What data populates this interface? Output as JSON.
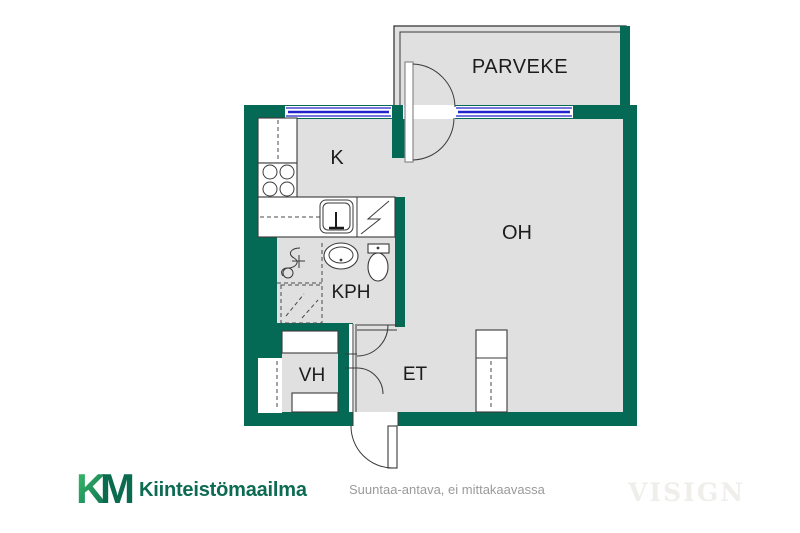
{
  "floorplan": {
    "rooms": {
      "balcony": {
        "label": "PARVEKE"
      },
      "kitchen": {
        "label": "K"
      },
      "living_room": {
        "label": "OH"
      },
      "bathroom": {
        "label": "KPH"
      },
      "closet": {
        "label": "VH"
      },
      "entry_hall": {
        "label": "ET"
      }
    }
  },
  "branding": {
    "logo_letter_k": "K",
    "logo_letter_m": "M",
    "agency_name": "Kiinteistömaailma"
  },
  "footer": {
    "disclaimer": "Suuntaa-antava, ei mittakaavassa",
    "watermark": "VISIGN"
  },
  "colors": {
    "wall_green": "#056a55",
    "floor_gray": "#e0e0e0",
    "window_blue": "#2323cb",
    "logo_light_green": "#3ec06c",
    "logo_dark_green": "#0b6b4f",
    "brand_text_green": "#0d6b52",
    "disclaimer_gray": "#9a9a9a",
    "watermark_gray": "#f0eeea"
  }
}
